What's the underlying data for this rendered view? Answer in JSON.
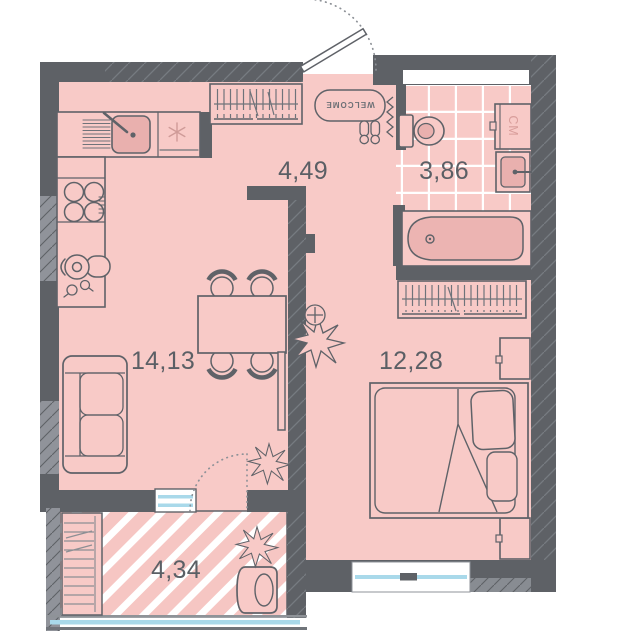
{
  "plan": {
    "rooms": [
      {
        "name": "hallway",
        "area": "4,49"
      },
      {
        "name": "bathroom",
        "area": "3,86"
      },
      {
        "name": "kitchen-living-room",
        "area": "14,13"
      },
      {
        "name": "bedroom",
        "area": "12,28"
      },
      {
        "name": "balcony",
        "area": "4,34"
      }
    ],
    "fixtures": {
      "doormat_text": "WELCOME",
      "washing_machine_label": "СМ"
    },
    "colors": {
      "wall": "#5e6166",
      "wall_light": "#90939a",
      "floor": "#f8cac7",
      "fixture_fill": "#e9b0ae",
      "tub_fill": "#ecb4b2",
      "glass": "#a9d9ea",
      "label_text": "#5b5f65",
      "tile_line": "#ffffff"
    }
  }
}
